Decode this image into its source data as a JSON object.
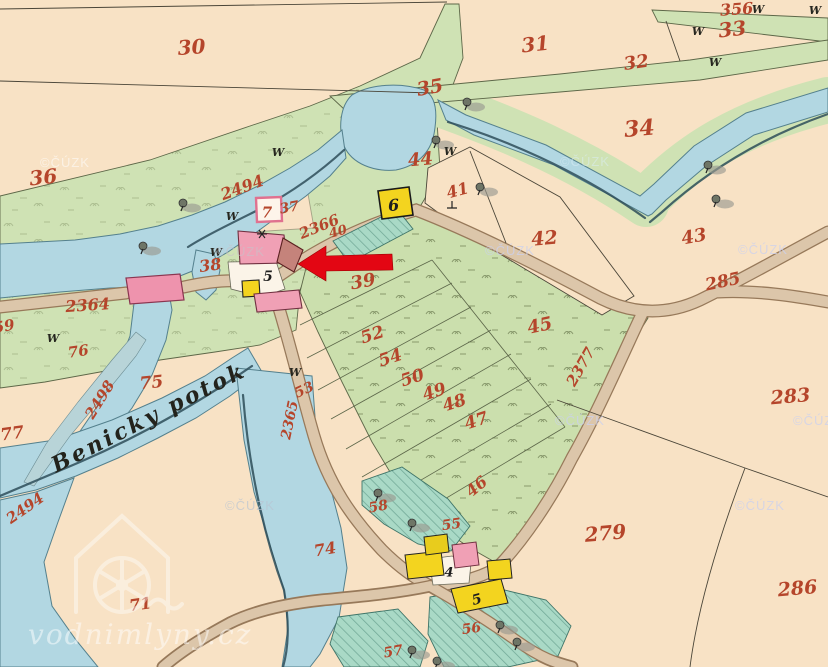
{
  "map": {
    "kind": "historical cadastral map sheet",
    "stream_label": "Benicky potok",
    "watermark_sources": {
      "archive": "©ČÚZK",
      "site": "vodnimlyny.cz"
    },
    "annotation": {
      "type": "arrow",
      "color": "#e30613",
      "points_at": "mill building parcel 5"
    },
    "palette": {
      "paper": "#f8e2c5",
      "meadow": "#cfe2b4",
      "field": "#cbdfad",
      "garden": "#a9d9c6",
      "water": "#b2d7e2",
      "road": "#dcc6aa",
      "building_masonry": "#f0a0b5",
      "building_wood": "#f3d41f",
      "bridge": "#ee93ad",
      "parcel_number": "#b5452b"
    },
    "parcel_numbers_red": [
      {
        "t": "30",
        "x": 192,
        "y": 47,
        "fs": 20,
        "r": -4
      },
      {
        "t": "31",
        "x": 536,
        "y": 44,
        "fs": 20,
        "r": -6
      },
      {
        "t": "32",
        "x": 637,
        "y": 62,
        "fs": 18,
        "r": -8
      },
      {
        "t": "33",
        "x": 733,
        "y": 29,
        "fs": 20,
        "r": -6
      },
      {
        "t": "356",
        "x": 737,
        "y": 9,
        "fs": 16,
        "r": -4
      },
      {
        "t": "34",
        "x": 640,
        "y": 128,
        "fs": 22,
        "r": -5
      },
      {
        "t": "35",
        "x": 431,
        "y": 87,
        "fs": 19,
        "r": -10
      },
      {
        "t": "36",
        "x": 44,
        "y": 177,
        "fs": 20,
        "r": -6
      },
      {
        "t": "44",
        "x": 421,
        "y": 159,
        "fs": 18,
        "r": -5
      },
      {
        "t": "41",
        "x": 459,
        "y": 190,
        "fs": 16,
        "r": -15
      },
      {
        "t": "42",
        "x": 545,
        "y": 238,
        "fs": 19,
        "r": -5
      },
      {
        "t": "43",
        "x": 695,
        "y": 236,
        "fs": 18,
        "r": -10
      },
      {
        "t": "285",
        "x": 724,
        "y": 281,
        "fs": 17,
        "r": -12
      },
      {
        "t": "2494",
        "x": 244,
        "y": 187,
        "fs": 16,
        "r": -20
      },
      {
        "t": "37",
        "x": 290,
        "y": 207,
        "fs": 14,
        "r": -10
      },
      {
        "t": "2366",
        "x": 321,
        "y": 226,
        "fs": 15,
        "r": -22
      },
      {
        "t": "40",
        "x": 339,
        "y": 231,
        "fs": 13,
        "r": -15
      },
      {
        "t": "38",
        "x": 211,
        "y": 265,
        "fs": 16,
        "r": -8
      },
      {
        "t": "39",
        "x": 364,
        "y": 281,
        "fs": 18,
        "r": -10
      },
      {
        "t": "2364",
        "x": 88,
        "y": 305,
        "fs": 16,
        "r": -4
      },
      {
        "t": "59",
        "x": 5,
        "y": 326,
        "fs": 15,
        "r": -10
      },
      {
        "t": "76",
        "x": 79,
        "y": 351,
        "fs": 15,
        "r": -8
      },
      {
        "t": "75",
        "x": 152,
        "y": 382,
        "fs": 17,
        "r": -6
      },
      {
        "t": "2498",
        "x": 104,
        "y": 397,
        "fs": 15,
        "r": -58
      },
      {
        "t": "77",
        "x": 13,
        "y": 433,
        "fs": 17,
        "r": -8
      },
      {
        "t": "2494",
        "x": 28,
        "y": 507,
        "fs": 15,
        "r": -35
      },
      {
        "t": "71",
        "x": 141,
        "y": 604,
        "fs": 16,
        "r": -8
      },
      {
        "t": "74",
        "x": 326,
        "y": 549,
        "fs": 16,
        "r": -10
      },
      {
        "t": "53",
        "x": 306,
        "y": 389,
        "fs": 14,
        "r": -25
      },
      {
        "t": "2365",
        "x": 294,
        "y": 416,
        "fs": 14,
        "r": -78
      },
      {
        "t": "52",
        "x": 374,
        "y": 334,
        "fs": 17,
        "r": -18
      },
      {
        "t": "54",
        "x": 392,
        "y": 357,
        "fs": 17,
        "r": -18
      },
      {
        "t": "50",
        "x": 414,
        "y": 377,
        "fs": 17,
        "r": -18
      },
      {
        "t": "49",
        "x": 436,
        "y": 391,
        "fs": 17,
        "r": -18
      },
      {
        "t": "48",
        "x": 456,
        "y": 402,
        "fs": 17,
        "r": -18
      },
      {
        "t": "47",
        "x": 478,
        "y": 420,
        "fs": 17,
        "r": -18
      },
      {
        "t": "45",
        "x": 541,
        "y": 325,
        "fs": 18,
        "r": -12
      },
      {
        "t": "46",
        "x": 480,
        "y": 485,
        "fs": 16,
        "r": -40
      },
      {
        "t": "2377",
        "x": 585,
        "y": 364,
        "fs": 15,
        "r": -60
      },
      {
        "t": "55",
        "x": 452,
        "y": 524,
        "fs": 14,
        "r": -8
      },
      {
        "t": "58",
        "x": 379,
        "y": 506,
        "fs": 14,
        "r": -10
      },
      {
        "t": "56",
        "x": 472,
        "y": 628,
        "fs": 14,
        "r": -8
      },
      {
        "t": "57",
        "x": 394,
        "y": 651,
        "fs": 14,
        "r": -10
      },
      {
        "t": "279",
        "x": 606,
        "y": 533,
        "fs": 20,
        "r": -5
      },
      {
        "t": "283",
        "x": 791,
        "y": 396,
        "fs": 19,
        "r": -5
      },
      {
        "t": "286",
        "x": 798,
        "y": 588,
        "fs": 19,
        "r": -5
      }
    ],
    "house_numbers_black": [
      {
        "t": "5",
        "x": 268,
        "y": 276,
        "fs": 14,
        "r": 0
      },
      {
        "t": "6",
        "x": 394,
        "y": 205,
        "fs": 16,
        "r": -5
      },
      {
        "t": "4",
        "x": 449,
        "y": 572,
        "fs": 13,
        "r": 0
      },
      {
        "t": "5",
        "x": 478,
        "y": 599,
        "fs": 14,
        "r": -15
      }
    ],
    "house_numbers_red_box": [
      {
        "t": "7",
        "x": 267,
        "y": 212,
        "fs": 15,
        "r": 0
      }
    ],
    "meadow_symbols_W": [
      [
        698,
        31
      ],
      [
        715,
        62
      ],
      [
        758,
        9
      ],
      [
        815,
        10
      ],
      [
        450,
        151
      ],
      [
        278,
        152
      ],
      [
        232,
        216
      ],
      [
        216,
        252
      ],
      [
        53,
        338
      ],
      [
        295,
        372
      ]
    ],
    "tree_symbols": [
      [
        183,
        203
      ],
      [
        143,
        246
      ],
      [
        467,
        102
      ],
      [
        436,
        140
      ],
      [
        480,
        187
      ],
      [
        708,
        165
      ],
      [
        716,
        199
      ],
      [
        412,
        523
      ],
      [
        500,
        625
      ],
      [
        517,
        642
      ],
      [
        412,
        650
      ],
      [
        378,
        493
      ],
      [
        437,
        661
      ]
    ],
    "czuk_watermarks": [
      {
        "x": 65,
        "y": 163,
        "c": "#ffffff",
        "o": 0.55
      },
      {
        "x": 585,
        "y": 162,
        "c": "#dceef6",
        "o": 0.5
      },
      {
        "x": 240,
        "y": 252,
        "c": "#c9c2c9",
        "o": 0.6
      },
      {
        "x": 510,
        "y": 251,
        "c": "#ccd1ee",
        "o": 0.75
      },
      {
        "x": 763,
        "y": 250,
        "c": "#ccd1ee",
        "o": 0.75
      },
      {
        "x": 250,
        "y": 506,
        "c": "#b9c4d2",
        "o": 0.65
      },
      {
        "x": 580,
        "y": 421,
        "c": "#ccd1ee",
        "o": 0.75
      },
      {
        "x": 760,
        "y": 506,
        "c": "#ccd1ee",
        "o": 0.75
      },
      {
        "x": 818,
        "y": 421,
        "c": "#ccd1ee",
        "o": 0.75
      }
    ]
  }
}
